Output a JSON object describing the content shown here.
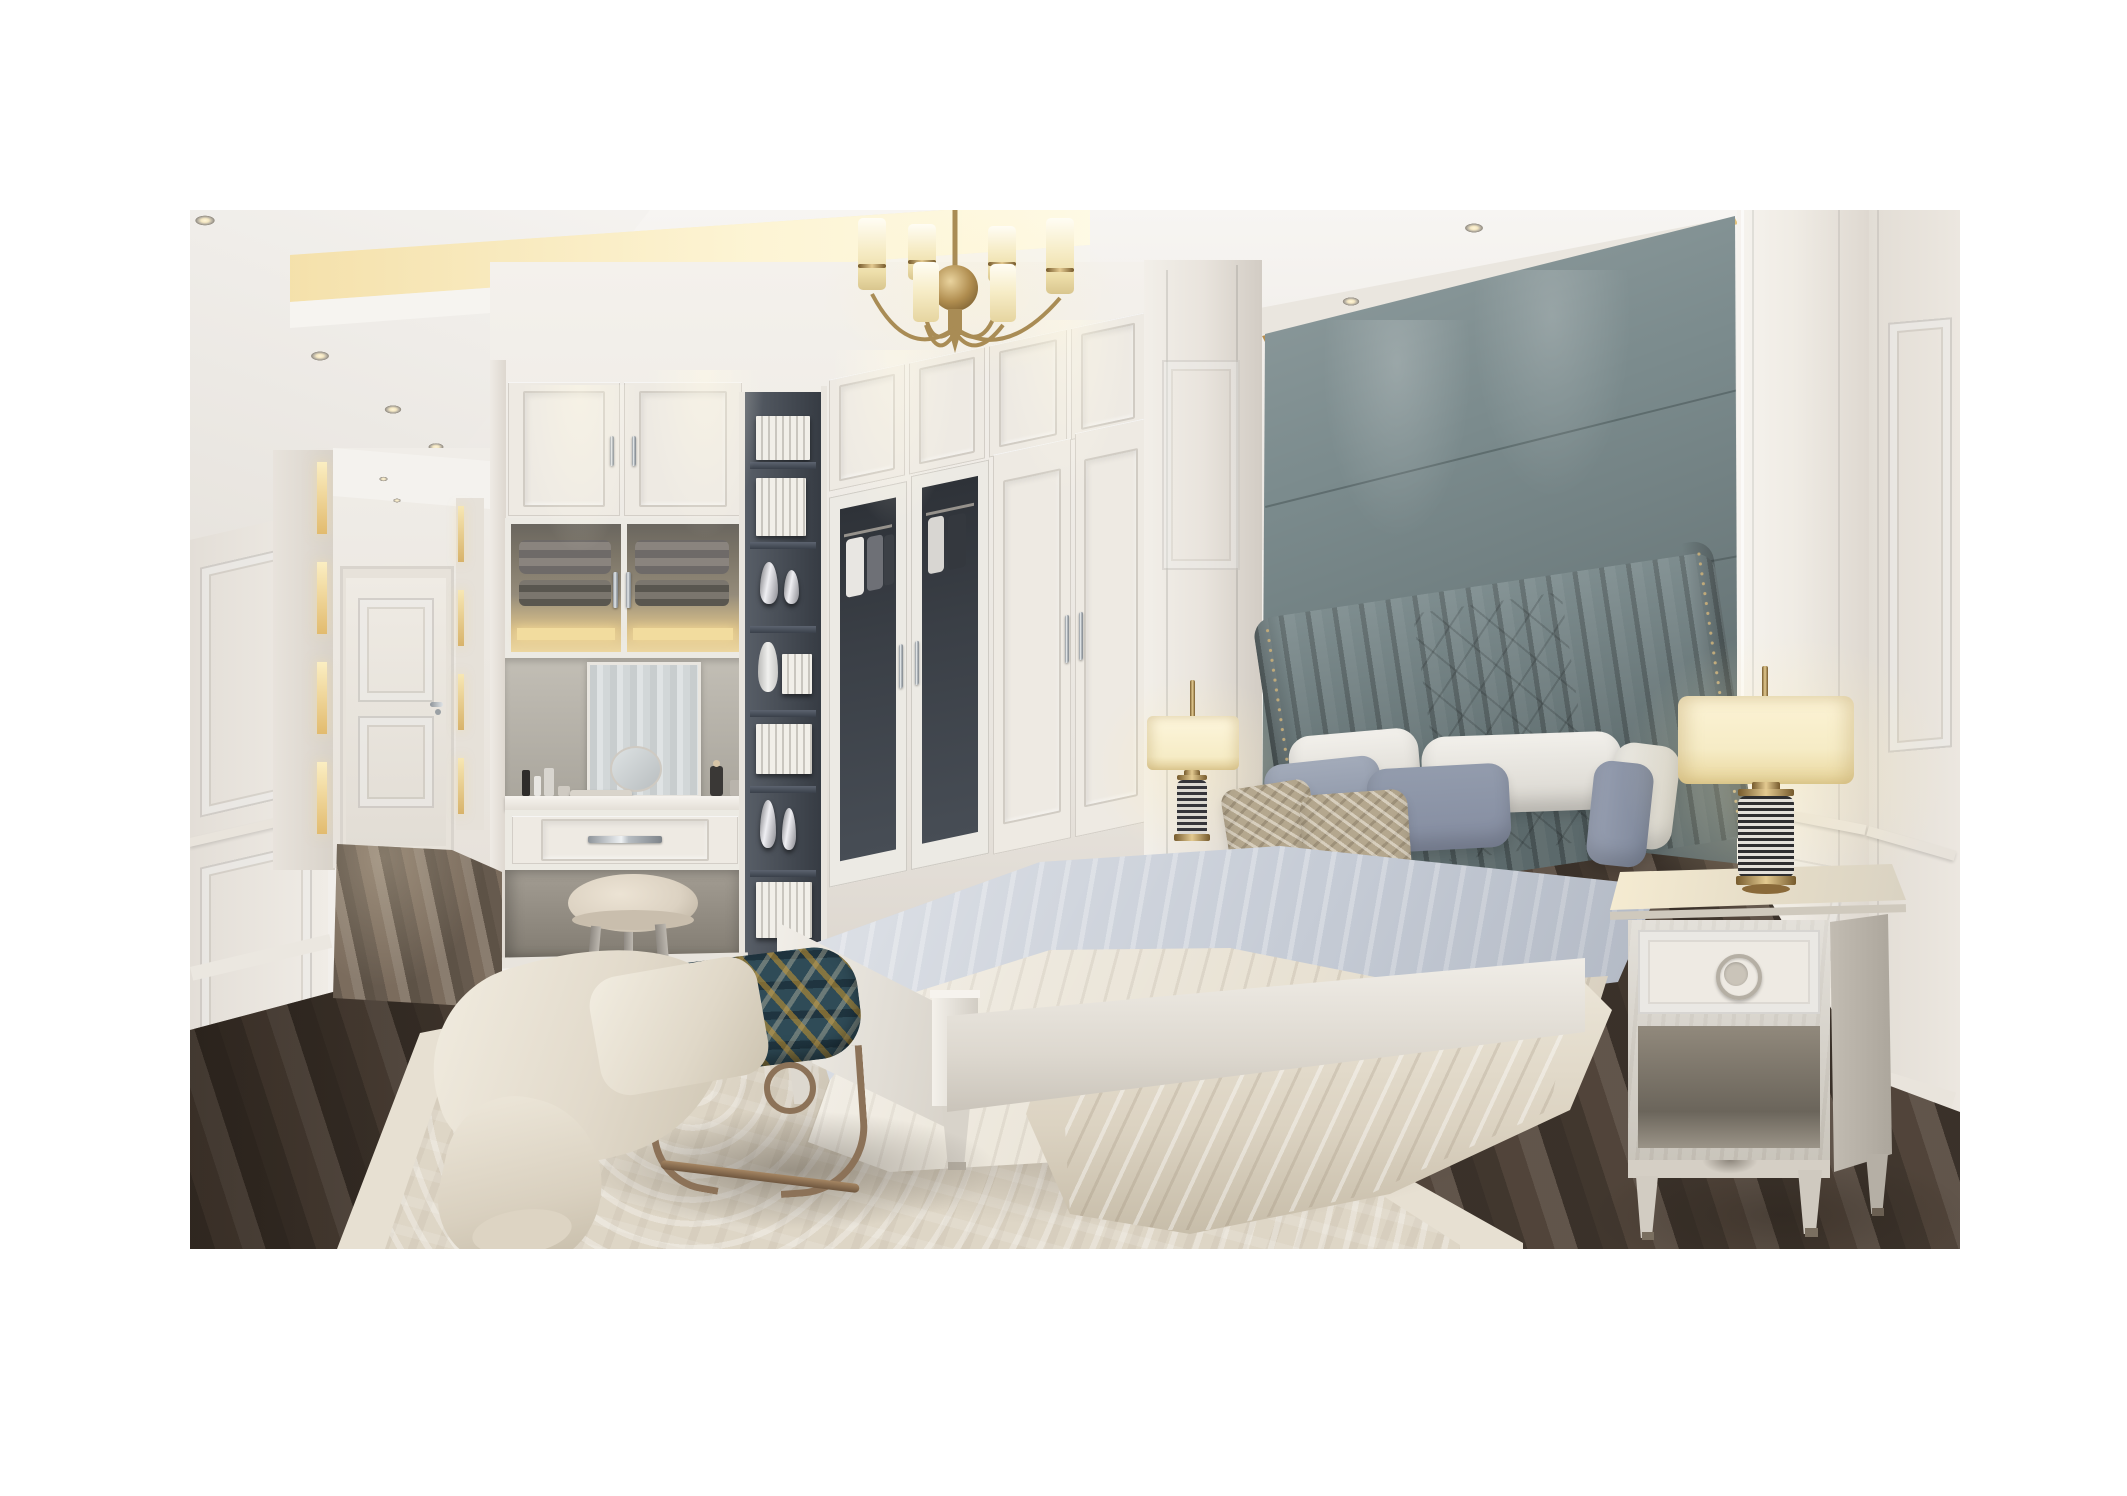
{
  "meta": {
    "description": "Photorealistic 3D interior rendering of a luxury light-luxury neoclassical bedroom with white built-in wardrobes, gray-green upholstered accent wall, brass chandelier and layered gray bedding",
    "image_type": "interior render photograph, no visible text"
  },
  "palette": {
    "canvas_white": "#ffffff",
    "ceiling_white": "#f2efeb",
    "cove_glow": "#f6e9bd",
    "wall_white": "#efebe5",
    "wall_shadow": "#d9d3cb",
    "door_white": "#eeeae3",
    "accent_panel_gray": "#7b8b8d",
    "headboard_gray": "#6f8082",
    "gold_trim": "#c9a050",
    "brass": "#b08d4f",
    "glass_dark": "#363b42",
    "tower_dark": "#454c56",
    "wood_floor": "#55483d",
    "wood_floor_light": "#7d6e5f",
    "rug_field": "#ded6c6",
    "rug_border": "#e7e0d2",
    "sheet_gray": "#c6ccd6",
    "bedding_cream": "#e7e0d1",
    "pillow_blue_gray": "#939cad",
    "pillow_taupe": "#b4a78e",
    "lamp_shade": "#f6ecc6",
    "bench_teal": "#2f4b57",
    "bronze_frame": "#8c7258",
    "nightstand_wood": "#d5d0c6",
    "stool_leather": "#dcd2c2"
  },
  "scene": {
    "objects": {
      "room": "Luxury neoclassical bedroom interior rendering",
      "ceiling": "Recessed tray ceiling with warm cove lighting and round downlights",
      "chandelier": "Brass chandelier with cylindrical frosted glass shades",
      "hallway": "Side hallway with wainscot paneling and white interior door",
      "hallway_door": "White two-panel interior door with chrome lever handle",
      "wardrobe": "White floor-to-ceiling paneled wardrobe wall with glass display doors",
      "vanity": "Built-in dressing vanity with mirror, cosmetics and pull-out drawer",
      "display_tower": "Dark open shelving tower styled with books and silver vases",
      "stool": "Round cream leather vanity stool",
      "accent_wall": "Gray-green upholstered accent wall panel with gold trim",
      "headboard": "Channel-tufted wingback headboard with brass nailhead trim",
      "bed": "King bed with light gray sheet and cream draped coverlet",
      "pillow_white": "Cream euro pillows",
      "pillow_blue": "Blue-gray accent pillows",
      "pillow_taupe": "Taupe patterned toss pillows",
      "bench": "Foot-of-bed bench with teal geometric cushion and bronze metal base",
      "throw": "Cream throw blanket draped over the bench",
      "nightstand_left": "White nightstand at left side of bed",
      "nightstand_right": "Light oak nightstand with ring-pull drawer and open shelf",
      "lamp_left": "Table lamp with cream shade and striped cylinder base",
      "lamp_right": "Table lamp with cream drum shade, brass fittings and striped base",
      "rug": "Cream area rug with tonal damask pattern",
      "floor": "Dark stained oak plank flooring"
    }
  }
}
